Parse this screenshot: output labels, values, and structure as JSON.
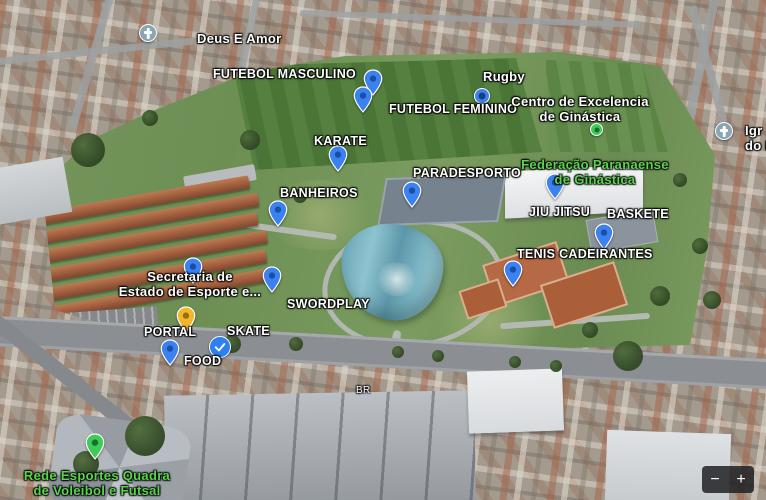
{
  "map_labels": {
    "deus_e_amor": "Deus E Amor",
    "futebol_masculino": "FUTEBOL MASCULINO",
    "rugby": "Rugby",
    "futebol_feminino": "FUTEBOL FEMININO",
    "centro_excelencia_line1": "Centro de Excelencia",
    "centro_excelencia_line2": "de Ginástica",
    "karate": "KARATE",
    "federacao_line1": "Federação Paranaense",
    "federacao_line2": "de Ginástica",
    "paradesporto": "PARADESPORTO",
    "banheiros": "BANHEIROS",
    "jiu_jitsu": "JIU JITSU",
    "baskete": "BASKETE",
    "tenis_cadeirantes": "TENIS CADEIRANTES",
    "secretaria_line1": "Secretaria de",
    "secretaria_line2": "Estado de Esporte e...",
    "swordplay": "SWORDPLAY",
    "portal": "PORTAL",
    "skate": "SKATE",
    "food": "FOOD",
    "rede_esportes_line1": "Rede Esportes Quadra",
    "rede_esportes_line2": "de Voleibol e Futsal",
    "igreja_line1": "Igr",
    "igreja_line2": "do B",
    "road": "BR"
  },
  "controls": {
    "zoom_in": "+",
    "zoom_out": "−"
  },
  "marker_colors": {
    "blue_pin": "#3b82f0",
    "blue_pin_center": "#1a4fa8",
    "yellow_pin": "#f4b62c",
    "yellow_pin_center": "#96700f",
    "green_pin": "#3ecb57",
    "green_pin_center": "#156f2e",
    "church_pin": "#8aa6b5",
    "saved_check_pin": "#2f80ef",
    "place_label_green": "#59d64b"
  }
}
